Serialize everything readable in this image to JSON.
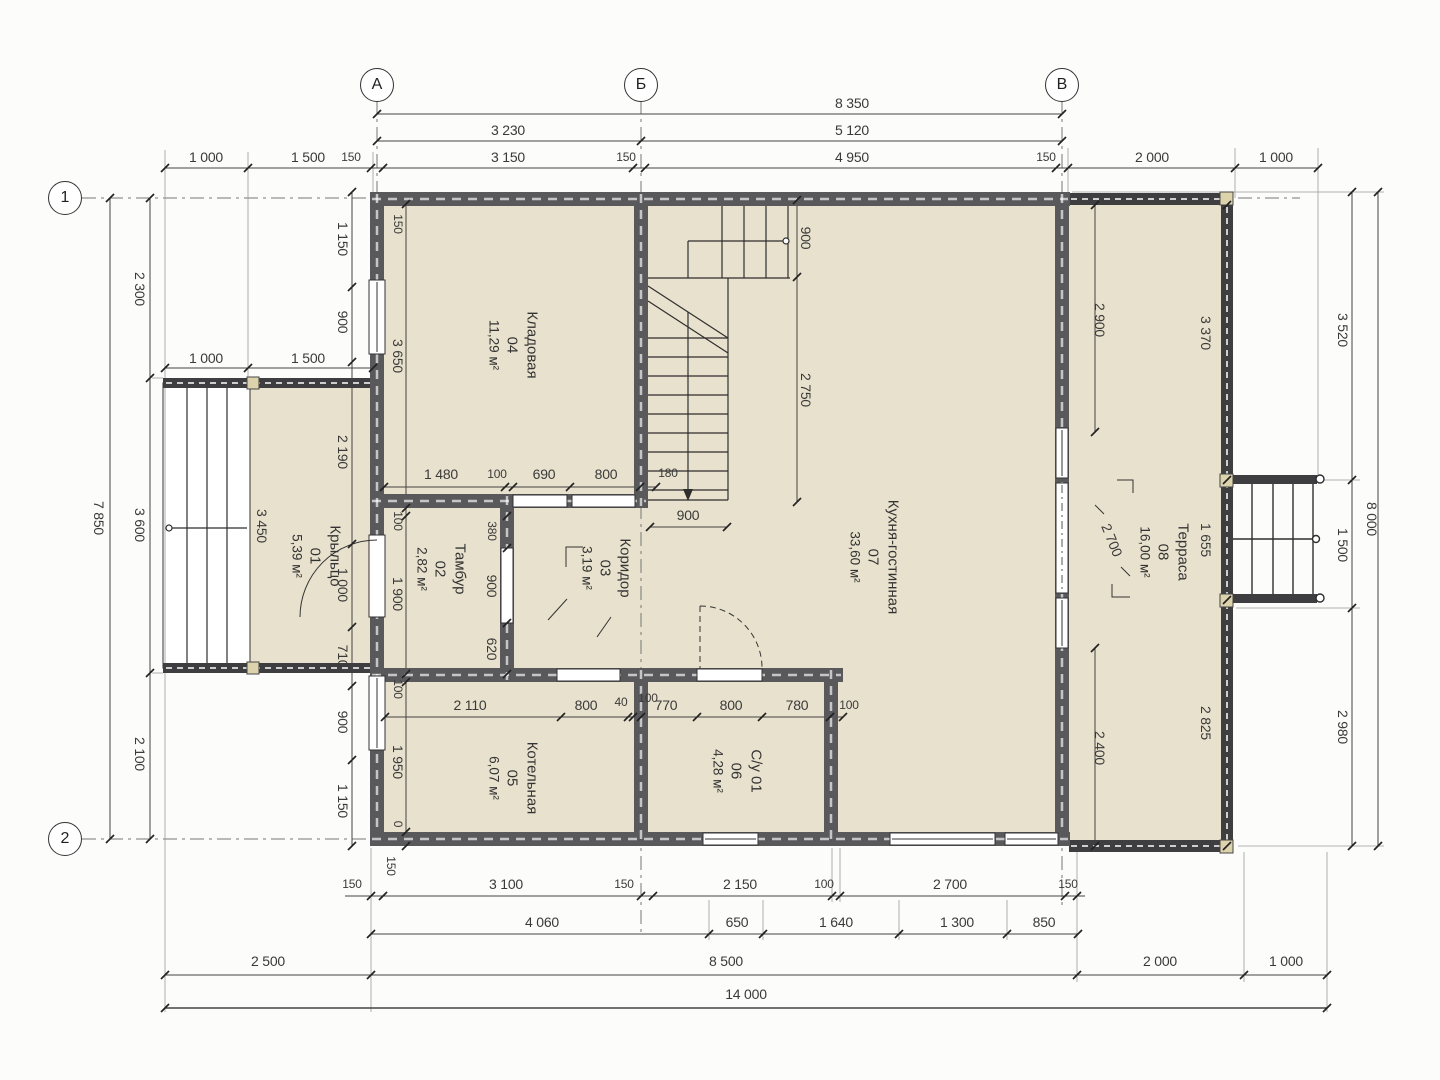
{
  "drawing_type": "Поэтажный план (1 этаж)",
  "colors": {
    "floor_fill": "#e8e1cd",
    "wall_fill": "#59595c",
    "line": "#2e2e2e",
    "dim_text": "#3a3a3a",
    "post_fill": "#dcd3ad",
    "background": "#fcfcfb"
  },
  "axes": [
    {
      "label": "А",
      "x": 377,
      "y": 85
    },
    {
      "label": "Б",
      "x": 641,
      "y": 85
    },
    {
      "label": "В",
      "x": 1062,
      "y": 85
    },
    {
      "label": "1",
      "x": 65,
      "y": 198
    },
    {
      "label": "2",
      "x": 65,
      "y": 839
    }
  ],
  "rooms": [
    {
      "name": "Кладовая",
      "num": "04",
      "area": "11,29 м²",
      "x": 513,
      "y": 345
    },
    {
      "name": "Тамбур",
      "num": "02",
      "area": "2,82 м²",
      "x": 441,
      "y": 569
    },
    {
      "name": "Коридор",
      "num": "03",
      "area": "3,19 м²",
      "x": 606,
      "y": 568
    },
    {
      "name": "Котельная",
      "num": "05",
      "area": "6,07 м²",
      "x": 513,
      "y": 778
    },
    {
      "name": "С/у 01",
      "num": "06",
      "area": "4,28 м²",
      "x": 737,
      "y": 771
    },
    {
      "name": "Кухня-гостинная",
      "num": "07",
      "area": "33,60 м²",
      "x": 874,
      "y": 557
    },
    {
      "name": "Крыльцо",
      "num": "01",
      "area": "5,39 м²",
      "x": 316,
      "y": 556
    },
    {
      "name": "Терраса",
      "num": "08",
      "area": "16,00 м²",
      "x": 1164,
      "y": 552
    }
  ],
  "dims": [
    {
      "t": "8 350",
      "x": 852,
      "y": 103
    },
    {
      "t": "3 230",
      "x": 508,
      "y": 130
    },
    {
      "t": "5 120",
      "x": 852,
      "y": 130
    },
    {
      "t": "1 000",
      "x": 206,
      "y": 157
    },
    {
      "t": "1 500",
      "x": 308,
      "y": 157
    },
    {
      "t": "150",
      "x": 351,
      "y": 157,
      "s": 1
    },
    {
      "t": "3 150",
      "x": 508,
      "y": 157
    },
    {
      "t": "150",
      "x": 626,
      "y": 157,
      "s": 1
    },
    {
      "t": "4 950",
      "x": 852,
      "y": 157
    },
    {
      "t": "150",
      "x": 1046,
      "y": 157,
      "s": 1
    },
    {
      "t": "2 000",
      "x": 1152,
      "y": 157
    },
    {
      "t": "1 000",
      "x": 1276,
      "y": 157
    },
    {
      "t": "7 850",
      "x": 99,
      "y": 518,
      "v": 1
    },
    {
      "t": "2 300",
      "x": 140,
      "y": 289,
      "v": 1
    },
    {
      "t": "3 600",
      "x": 140,
      "y": 525,
      "v": 1
    },
    {
      "t": "2 100",
      "x": 140,
      "y": 754,
      "v": 1
    },
    {
      "t": "1 000",
      "x": 206,
      "y": 358
    },
    {
      "t": "1 500",
      "x": 308,
      "y": 358
    },
    {
      "t": "1 150",
      "x": 343,
      "y": 239,
      "v": 1
    },
    {
      "t": "900",
      "x": 343,
      "y": 322,
      "v": 1
    },
    {
      "t": "2 190",
      "x": 343,
      "y": 452,
      "v": 1
    },
    {
      "t": "1 000",
      "x": 343,
      "y": 585,
      "v": 1
    },
    {
      "t": "710",
      "x": 343,
      "y": 656,
      "v": 1
    },
    {
      "t": "900",
      "x": 343,
      "y": 722,
      "v": 1
    },
    {
      "t": "1 150",
      "x": 343,
      "y": 801,
      "v": 1
    },
    {
      "t": "3 450",
      "x": 262,
      "y": 526,
      "v": 1
    },
    {
      "t": "150",
      "x": 398,
      "y": 224,
      "v": 1,
      "s": 1
    },
    {
      "t": "3 650",
      "x": 398,
      "y": 356,
      "v": 1
    },
    {
      "t": "100",
      "x": 398,
      "y": 521,
      "v": 1,
      "s": 1
    },
    {
      "t": "1 900",
      "x": 398,
      "y": 594,
      "v": 1
    },
    {
      "t": "100",
      "x": 398,
      "y": 689,
      "v": 1,
      "s": 1
    },
    {
      "t": "1 950",
      "x": 398,
      "y": 762,
      "v": 1
    },
    {
      "t": "0",
      "x": 398,
      "y": 824,
      "v": 1,
      "s": 1
    },
    {
      "t": "150",
      "x": 391,
      "y": 866,
      "v": 1,
      "s": 1
    },
    {
      "t": "1 480",
      "x": 441,
      "y": 474
    },
    {
      "t": "100",
      "x": 497,
      "y": 474,
      "s": 1
    },
    {
      "t": "690",
      "x": 544,
      "y": 474
    },
    {
      "t": "800",
      "x": 606,
      "y": 474
    },
    {
      "t": "180",
      "x": 668,
      "y": 473,
      "s": 1
    },
    {
      "t": "900",
      "x": 688,
      "y": 515
    },
    {
      "t": "900",
      "x": 806,
      "y": 238,
      "v": 1
    },
    {
      "t": "2 750",
      "x": 806,
      "y": 390,
      "v": 1
    },
    {
      "t": "380",
      "x": 492,
      "y": 531,
      "v": 1,
      "s": 1
    },
    {
      "t": "900",
      "x": 492,
      "y": 586,
      "v": 1
    },
    {
      "t": "620",
      "x": 492,
      "y": 649,
      "v": 1
    },
    {
      "t": "2 110",
      "x": 470,
      "y": 705
    },
    {
      "t": "800",
      "x": 586,
      "y": 705
    },
    {
      "t": "40",
      "x": 621,
      "y": 702,
      "s": 1
    },
    {
      "t": "100",
      "x": 648,
      "y": 698,
      "s": 1
    },
    {
      "t": "770",
      "x": 666,
      "y": 705
    },
    {
      "t": "800",
      "x": 731,
      "y": 705
    },
    {
      "t": "780",
      "x": 797,
      "y": 705
    },
    {
      "t": "100",
      "x": 849,
      "y": 705,
      "s": 1
    },
    {
      "t": "2 900",
      "x": 1100,
      "y": 320,
      "v": 1
    },
    {
      "t": "2 400",
      "x": 1100,
      "y": 748,
      "v": 1
    },
    {
      "t": "2 700",
      "x": 1112,
      "y": 540,
      "r": 68
    },
    {
      "t": "3 370",
      "x": 1206,
      "y": 333,
      "v": 1
    },
    {
      "t": "1 655",
      "x": 1206,
      "y": 540,
      "v": 1
    },
    {
      "t": "2 825",
      "x": 1206,
      "y": 723,
      "v": 1
    },
    {
      "t": "3 520",
      "x": 1343,
      "y": 330,
      "v": 1
    },
    {
      "t": "1 500",
      "x": 1343,
      "y": 545,
      "v": 1
    },
    {
      "t": "2 980",
      "x": 1343,
      "y": 727,
      "v": 1
    },
    {
      "t": "8 000",
      "x": 1372,
      "y": 519,
      "v": 1
    },
    {
      "t": "150",
      "x": 352,
      "y": 884,
      "s": 1
    },
    {
      "t": "3 100",
      "x": 506,
      "y": 884
    },
    {
      "t": "150",
      "x": 624,
      "y": 884,
      "s": 1
    },
    {
      "t": "2 150",
      "x": 740,
      "y": 884
    },
    {
      "t": "100",
      "x": 824,
      "y": 884,
      "s": 1
    },
    {
      "t": "2 700",
      "x": 950,
      "y": 884
    },
    {
      "t": "150",
      "x": 1068,
      "y": 884,
      "s": 1
    },
    {
      "t": "4 060",
      "x": 542,
      "y": 922
    },
    {
      "t": "650",
      "x": 737,
      "y": 922
    },
    {
      "t": "1 640",
      "x": 836,
      "y": 922
    },
    {
      "t": "1 300",
      "x": 957,
      "y": 922
    },
    {
      "t": "850",
      "x": 1044,
      "y": 922
    },
    {
      "t": "2 500",
      "x": 268,
      "y": 961
    },
    {
      "t": "8 500",
      "x": 726,
      "y": 961
    },
    {
      "t": "2 000",
      "x": 1160,
      "y": 961
    },
    {
      "t": "1 000",
      "x": 1286,
      "y": 961
    },
    {
      "t": "14 000",
      "x": 746,
      "y": 994
    }
  ]
}
